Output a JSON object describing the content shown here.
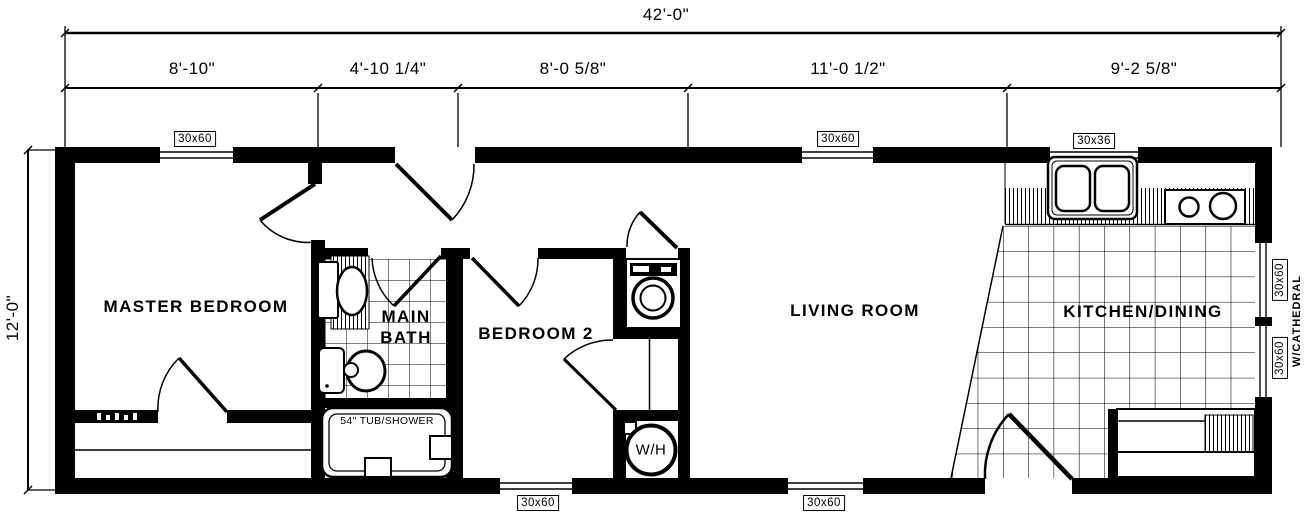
{
  "drawing": {
    "type": "single-wide floor plan",
    "ink": "#000000",
    "background": "#ffffff"
  },
  "dimensions": {
    "overall_width": "42'-0\"",
    "overall_depth": "12'-0\"",
    "top_segments": [
      {
        "label": "8'-10\""
      },
      {
        "label": "4'-10 1/4\""
      },
      {
        "label": "8'-0 5/8\""
      },
      {
        "label": "11'-0 1/2\""
      },
      {
        "label": "9'-2 5/8\""
      }
    ]
  },
  "rooms": {
    "master_bedroom": "MASTER BEDROOM",
    "main_bath_line1": "MAIN",
    "main_bath_line2": "BATH",
    "bedroom2": "BEDROOM 2",
    "living_room": "LIVING ROOM",
    "kitchen_dining": "KITCHEN/DINING"
  },
  "windows": {
    "master_top": "30x60",
    "living_top": "30x60",
    "kitchen_top": "30x36",
    "kitchen_right_upper": "30x60",
    "kitchen_right_lower": "30x60",
    "bedroom2_bottom": "30x60",
    "living_bottom": "30x60"
  },
  "fixtures": {
    "tub": "54\" TUB/SHOWER",
    "water_heater": "W/H"
  },
  "notes": {
    "cathedral": "W/CATHEDRAL"
  }
}
